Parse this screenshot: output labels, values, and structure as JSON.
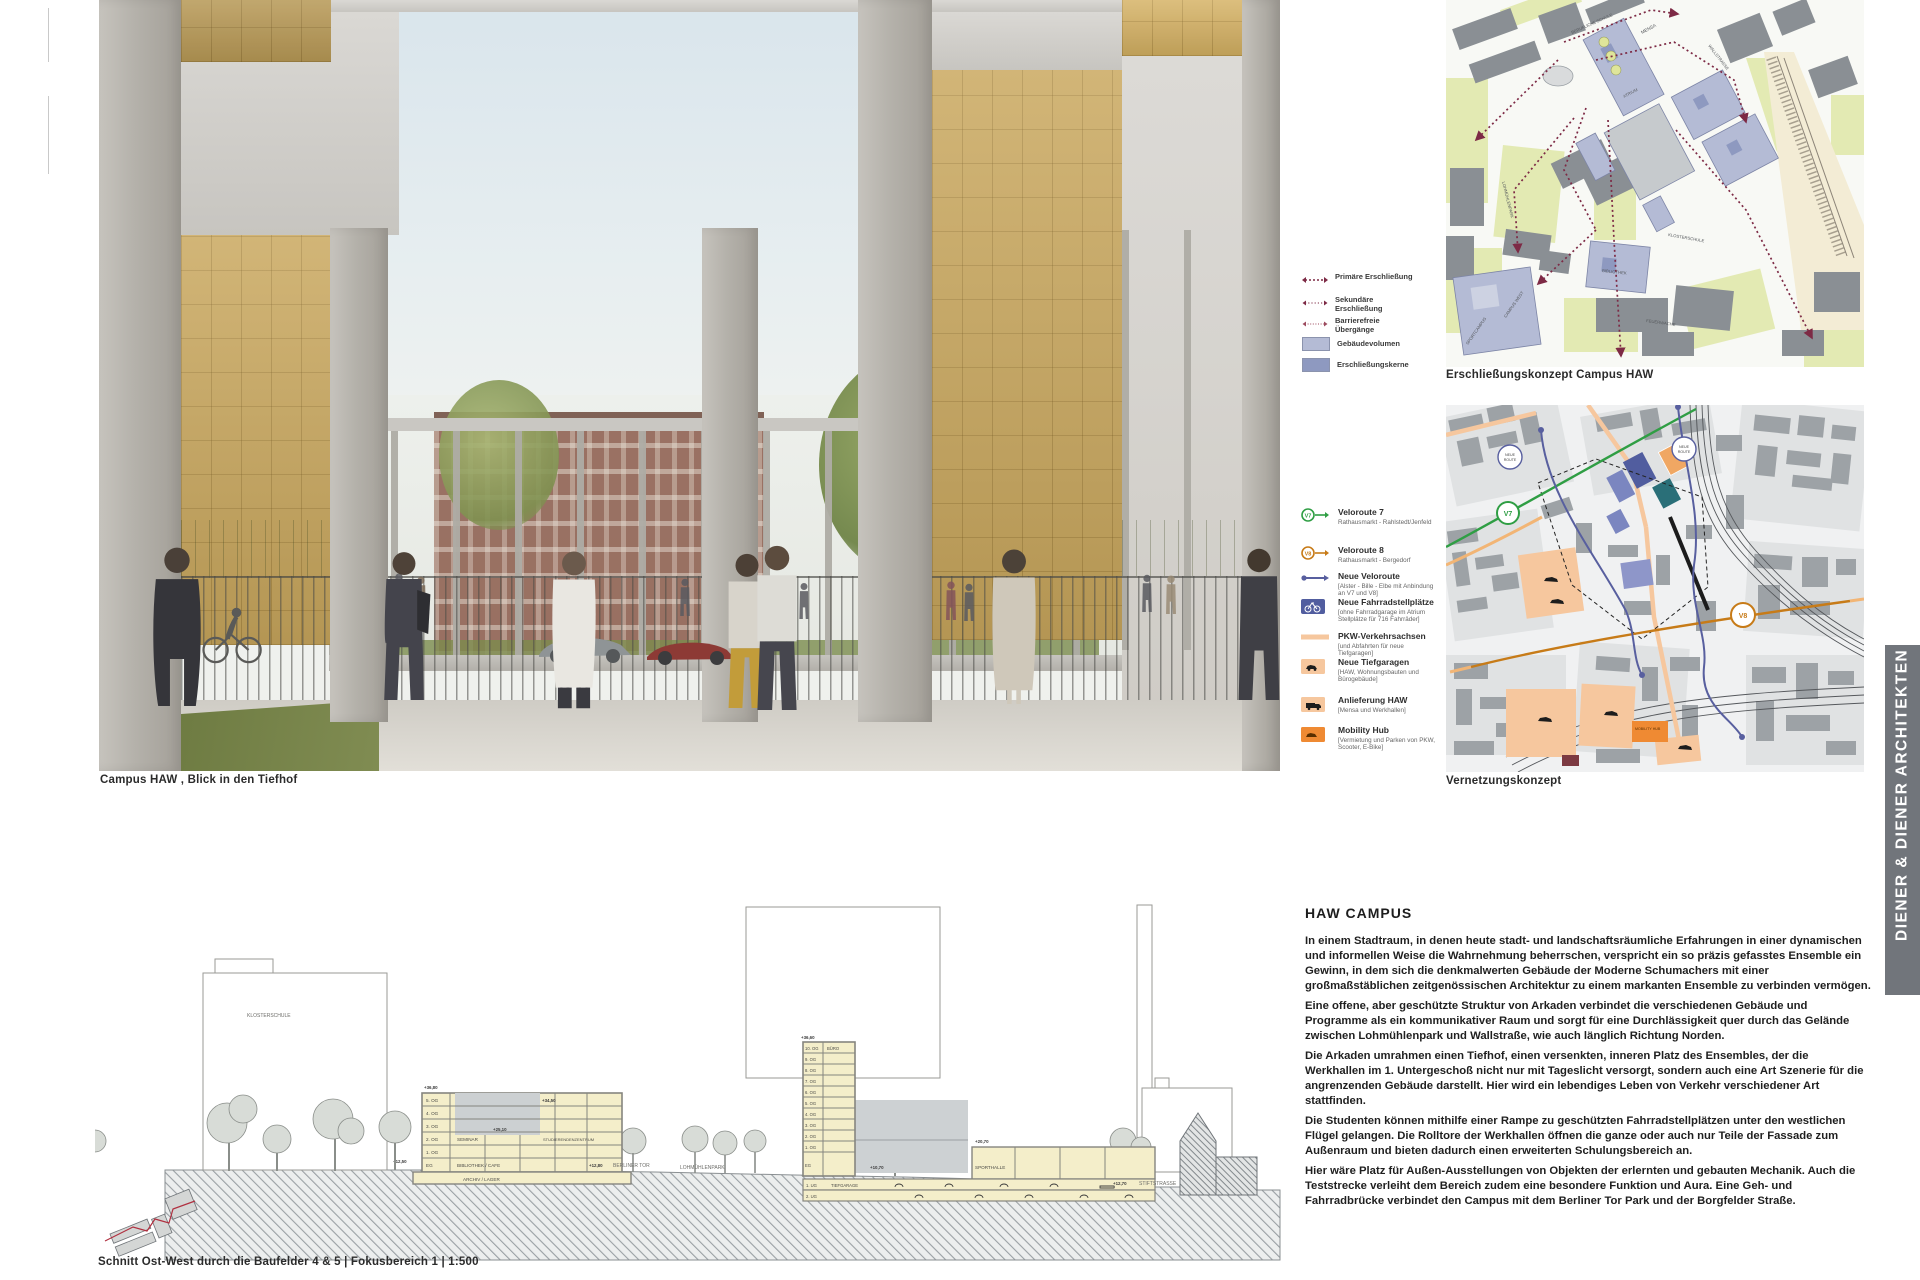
{
  "architect": "DIENER & DIENER ARCHITEKTEN",
  "rendering": {
    "caption": "Campus HAW ,  Blick in den Tiefhof"
  },
  "maps": {
    "map1": {
      "caption": "Erschließungskonzept Campus HAW",
      "legend": [
        {
          "label": "Primäre Erschließung"
        },
        {
          "label": "Sekundäre Erschließung"
        },
        {
          "label": "Barrierefreie Übergänge"
        },
        {
          "label": "Gebäudevolumen"
        },
        {
          "label": "Erschließungskerne"
        }
      ],
      "labels": {
        "wallstrasse": "WALLSTRASSE",
        "berufliche_schule": "BERUFLICHE SCHULE",
        "mensa": "MENSA",
        "atrium": "ATRIUM",
        "bibliothek": "BIBLIOTHEK",
        "campus_west": "CAMPUS WEST",
        "sportcampus": "SPORTCAMPUS",
        "lohmuehlenpark": "LOHMÜHLENPARK",
        "klosterschule": "KLOSTERSCHULE",
        "feuerwache": "FEUERWACHE"
      }
    },
    "map2": {
      "caption": "Vernetzungskonzept",
      "legend": [
        {
          "label": "Veloroute 7",
          "sub": "Rathausmarkt - Rahlstedt/Jenfeld"
        },
        {
          "label": "Veloroute 8",
          "sub": "Rathausmarkt - Bergedorf"
        },
        {
          "label": "Neue Veloroute",
          "sub": "[Alster - Bille - Elbe mit Anbindung an V7 und V8]"
        },
        {
          "label": "Neue Fahrradstellplätze",
          "sub": "[ohne Fahrradgarage im Atrium Stellplätze für 716 Fahrräder]"
        },
        {
          "label": "PKW-Verkehrsachsen",
          "sub": "[und Abfahrten für neue Tiefgaragen]"
        },
        {
          "label": "Neue Tiefgaragen",
          "sub": "[HAW, Wohnungsbauten und Bürogebäude]"
        },
        {
          "label": "Anlieferung HAW",
          "sub": "[Mensa und Werkhallen]"
        },
        {
          "label": "Mobility Hub",
          "sub": "[Vermietung und Parken von PKW, Scooter, E-Bike]"
        }
      ],
      "badges": {
        "v7": "V7",
        "v8": "V8",
        "neue": "NEUE",
        "route": "ROUTE"
      },
      "mobility_hub": "MOBILITY HUB"
    }
  },
  "section": {
    "caption": "Schnitt Ost-West durch die Baufelder 4 & 5  |  Fokusbereich 1  |  1:500",
    "building_a": {
      "floors": [
        "5. OG",
        "4. OG",
        "3. OG",
        "2. OG",
        "1. OG",
        "EG"
      ],
      "rooms": {
        "seminar": "SEMINAR",
        "studierendenzentrum": "STUDIERENDENZENTRUM",
        "bibliothek": "BIBLIOTHEK / CAFE",
        "archiv": "ARCHIV / LAGER"
      },
      "elevations": {
        "top": "+36,80",
        "inner": "+34,50",
        "atrium": "+25,10",
        "eg": "+12,80"
      }
    },
    "building_b": {
      "floors": [
        "10. OG",
        "9. OG",
        "8. OG",
        "7. OG",
        "6. OG",
        "5. OG",
        "4. OG",
        "3. OG",
        "2. OG",
        "1. OG",
        "EG"
      ],
      "rooms": {
        "buero": "BÜRO",
        "sporthalle": "SPORTHALLE",
        "tiefgarage": "TIEFGARAGE"
      },
      "ug": [
        "1. UG",
        "2. UG"
      ],
      "elevations": {
        "top": "+36,60",
        "court": "+10,70",
        "sport": "+20,70",
        "street": "+12,70"
      }
    },
    "context": {
      "klosterschule": "KLOSTERSCHULE",
      "klosterschule_elev": "+12,50",
      "berliner_tor": "BERLINER TOR",
      "lohmuehlenpark": "LOHMÜHLENPARK",
      "stiftstrasse": "STIFTSTRASSE"
    }
  },
  "article": {
    "title": "HAW  CAMPUS",
    "paragraphs": [
      "In einem Stadtraum, in denen heute stadt- und landschaftsräumliche Erfahrungen in einer dynamischen und informellen Weise die Wahrnehmung beherrschen, verspricht ein so präzis gefasstes Ensemble ein Gewinn, in dem sich die denkmalwerten Gebäude der Moderne Schumachers mit einer großmaßstäblichen zeitgenössischen Architektur zu einem markanten Ensemble zu verbinden vermögen.",
      "Eine offene, aber geschützte Struktur von Arkaden verbindet die verschiedenen Gebäude und Programme als ein kommunikativer Raum und sorgt für eine Durchlässigkeit quer durch das Gelände zwischen Lohmühlenpark und Wallstraße, wie auch länglich Richtung Norden.",
      "Die Arkaden umrahmen einen Tiefhof, einen versenkten, inneren Platz des Ensembles, der die Werkhallen im 1. Untergeschoß nicht nur mit Tageslicht versorgt, sondern auch eine Art Szenerie für die angrenzenden Gebäude darstellt. Hier wird ein lebendiges Leben von Verkehr verschiedener Art stattfinden.",
      "Die Studenten können mithilfe einer Rampe zu geschützten Fahrradstellplätzen unter den westlichen Flügel gelangen. Die Rolltore der Werkhallen öffnen die ganze oder auch nur Teile der Fassade zum Außenraum und bieten dadurch einen erweiterten Schulungsbereich an.",
      "Hier wäre Platz für Außen-Ausstellungen von Objekten der erlernten und gebauten Mechanik. Auch die Teststrecke verleiht dem Bereich zudem eine besondere Funktion und Aura. Eine Geh- und Fahrradbrücke verbindet den Campus mit dem Berliner Tor Park und der Borgfelder Straße."
    ]
  },
  "colors": {
    "accent_route": "#7d2a45",
    "veloroute7": "#2f9e44",
    "veloroute8": "#c77b18",
    "campus_blue": "#b4bbd5",
    "core_blue": "#8e99c0",
    "amber": "#c9a75d"
  }
}
